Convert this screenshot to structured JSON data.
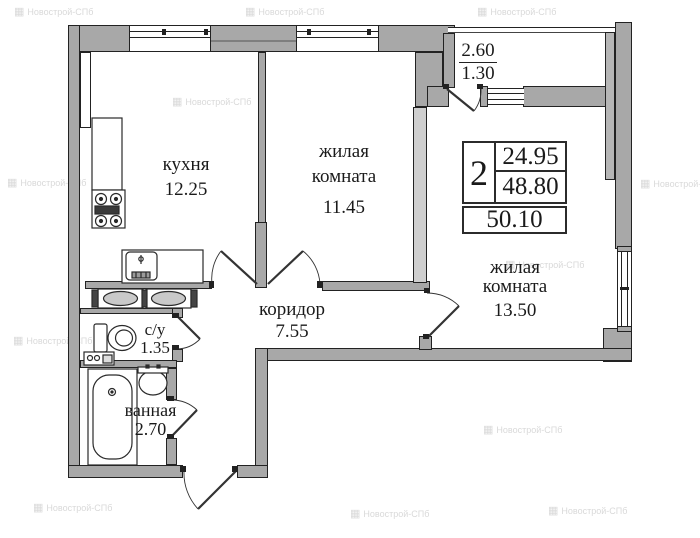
{
  "labels": {
    "kitchen": {
      "line1": "кухня",
      "area": "12.25"
    },
    "room1": {
      "line1": "жилая",
      "line2": "комната",
      "area": "11.45"
    },
    "room2": {
      "line1": "жилая",
      "line2": "комната",
      "area": "13.50"
    },
    "corridor": {
      "line1": "коридор",
      "area": "7.55"
    },
    "wc": {
      "line1": "с/у",
      "area": "1.35"
    },
    "bath": {
      "line1": "ванная",
      "area": "2.70"
    },
    "balcony": {
      "total": "2.60",
      "reduced": "1.30"
    }
  },
  "info_table": {
    "rooms_count": "2",
    "living_area": "24.95",
    "area_without_balcony": "48.80",
    "total_area": "50.10"
  },
  "watermark": {
    "text": "Новострой-СПб",
    "icon": "building-grid-icon",
    "color": "#d9d9d9"
  },
  "colors": {
    "wall_fill": "#a8a8a8",
    "wall_outline": "#222222",
    "divider_fill": "#cfcfcf",
    "text": "#1a1a1a"
  }
}
